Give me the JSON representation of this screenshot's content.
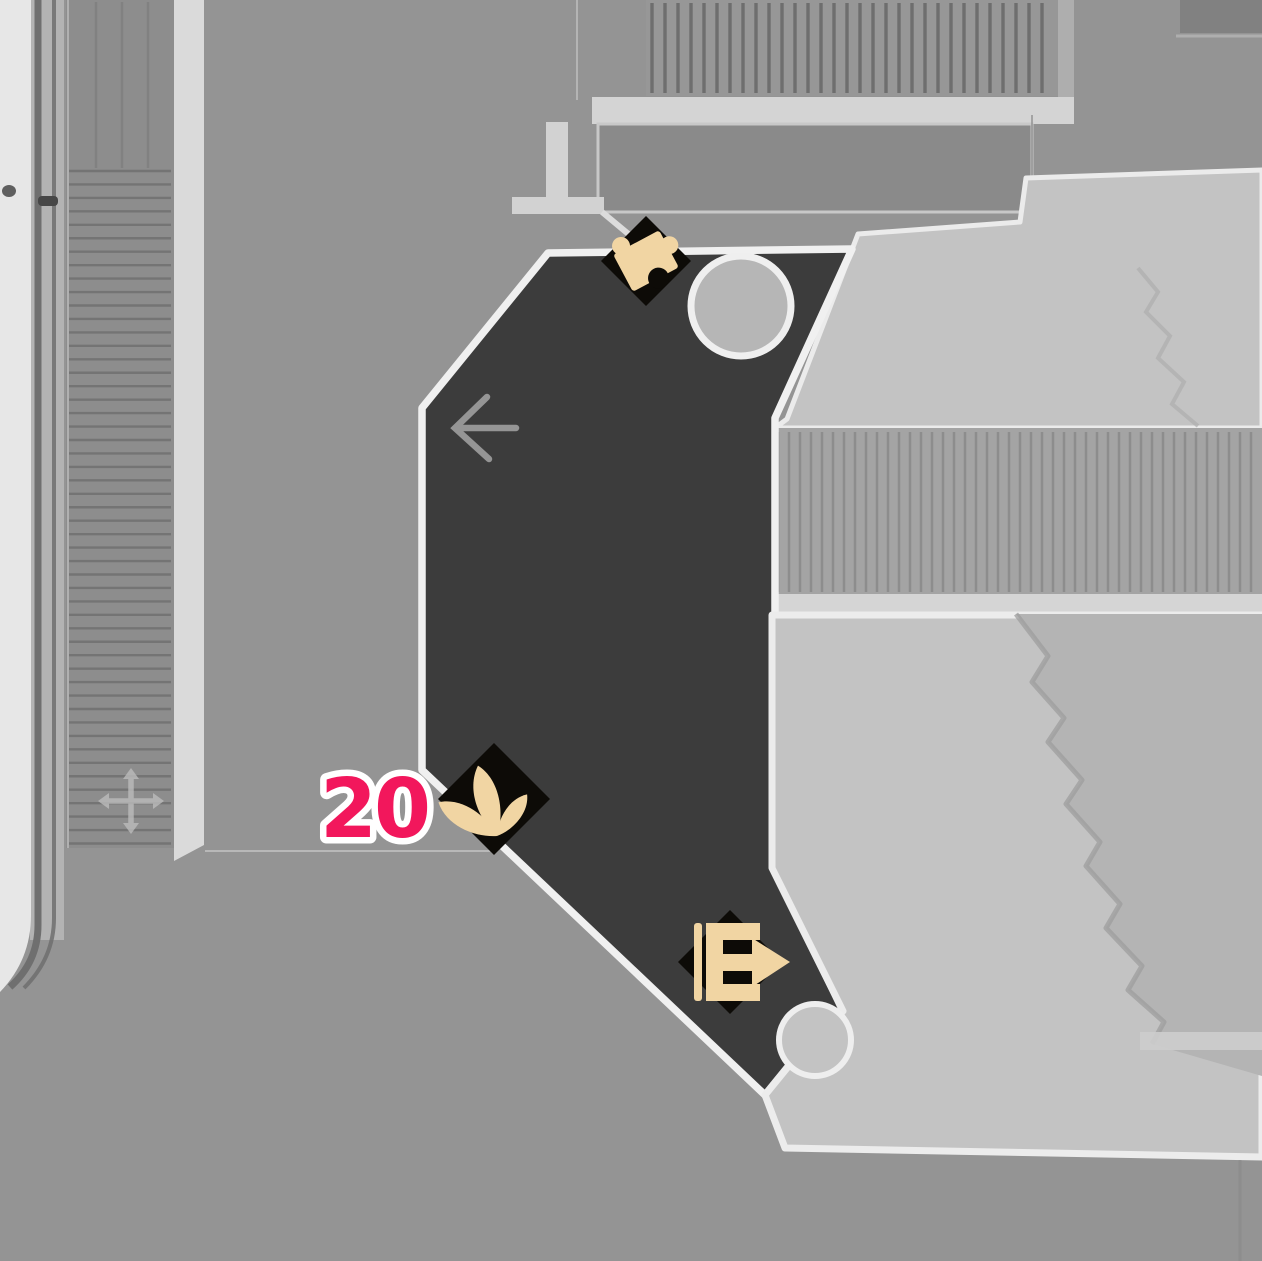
{
  "map": {
    "plant_marker": {
      "glyph": "three-petal-sprout",
      "count_label": "20",
      "label_color": "#f2175c",
      "label_outline_color": "#ffffff"
    },
    "puzzle_marker": {
      "glyph": "puzzle-piece"
    },
    "exit_marker": {
      "glyph": "door-exit-arrow"
    },
    "room_arrow": {
      "glyph": "left-arrow"
    },
    "colors": {
      "marker_gold": "#f1d5a3",
      "marker_diamond": "#0d0b07",
      "room_fill": "#3c3c3c",
      "room_border": "#f0f0f0",
      "floor": "#949494",
      "platform_light": "#c3c3c3",
      "accent_pink": "#f2175c"
    }
  }
}
